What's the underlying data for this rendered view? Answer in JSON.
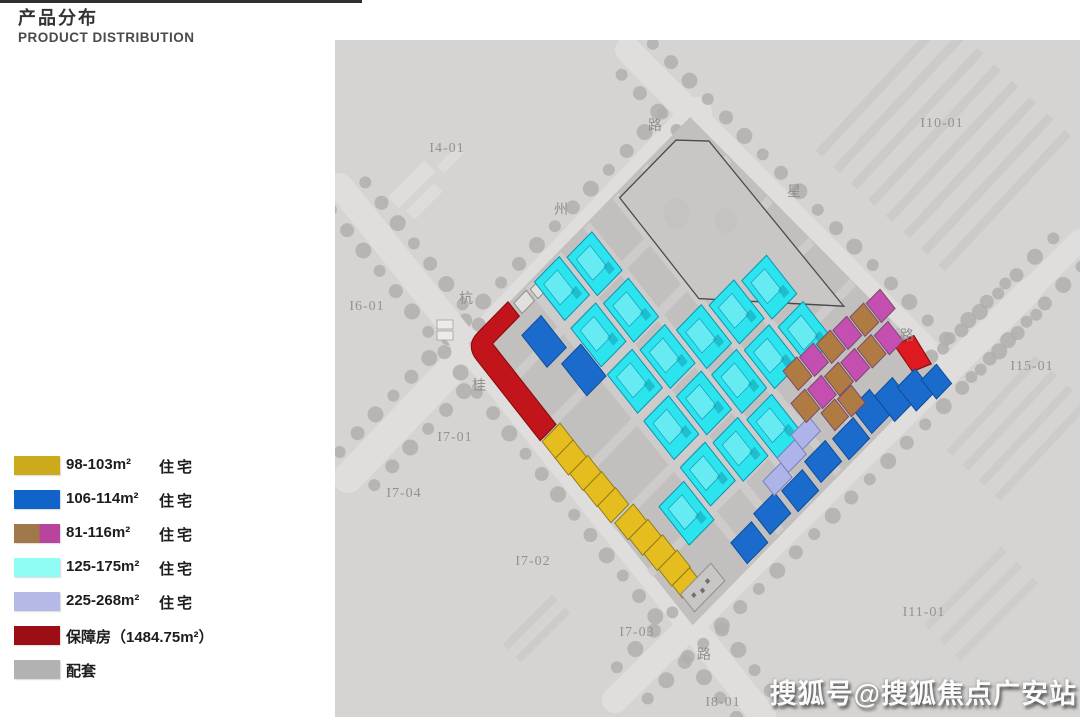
{
  "header": {
    "title_zh": "产品分布",
    "title_en": "PRODUCT DISTRIBUTION"
  },
  "watermark": "搜狐号@搜狐焦点广安站",
  "legend": {
    "items": [
      {
        "id": "98-103",
        "range": "98-103m²",
        "category": "住宅",
        "colors": [
          "#cbaa1c"
        ]
      },
      {
        "id": "106-114",
        "range": "106-114m²",
        "category": "住宅",
        "colors": [
          "#1063c8"
        ]
      },
      {
        "id": "81-116",
        "range": "81-116m²",
        "category": "住宅",
        "colors": [
          "#a0794a",
          "#b8449e"
        ]
      },
      {
        "id": "125-175",
        "range": "125-175m²",
        "category": "住宅",
        "colors": [
          "#8ffdf4"
        ]
      },
      {
        "id": "225-268",
        "range": "225-268m²",
        "category": "住宅",
        "colors": [
          "#b4b9e8"
        ]
      },
      {
        "id": "baozhangfang",
        "range": "保障房（1484.75m²）",
        "category": "",
        "colors": [
          "#9c0d15"
        ]
      },
      {
        "id": "peitao",
        "range": "配套",
        "category": "",
        "colors": [
          "#b2b2b2"
        ]
      }
    ]
  },
  "map": {
    "region": {
      "x": 335,
      "y": 40,
      "w": 745,
      "h": 677
    },
    "background": "#d6d4d2",
    "road_color": "#e0dedc",
    "tree_color": "#b2b0ae",
    "site_base": "#c2c0be",
    "inner_road_color": "#d0cecc",
    "roads": [
      {
        "x1": 348,
        "y1": 478,
        "x2": 697,
        "y2": 112,
        "w": 30
      },
      {
        "x1": 340,
        "y1": 186,
        "x2": 763,
        "y2": 716,
        "w": 26
      },
      {
        "x1": 628,
        "y1": 50,
        "x2": 948,
        "y2": 372,
        "w": 26
      },
      {
        "x1": 1030,
        "y1": 290,
        "x2": 615,
        "y2": 700,
        "w": 26
      },
      {
        "x1": 948,
        "y1": 372,
        "x2": 1080,
        "y2": 240,
        "w": 22
      }
    ],
    "parcel_labels": [
      {
        "text": "I4-01",
        "x": 447,
        "y": 152
      },
      {
        "text": "I10-01",
        "x": 942,
        "y": 127
      },
      {
        "text": "I6-01",
        "x": 367,
        "y": 310
      },
      {
        "text": "I15-01",
        "x": 1032,
        "y": 370
      },
      {
        "text": "I7-01",
        "x": 455,
        "y": 441
      },
      {
        "text": "I7-04",
        "x": 404,
        "y": 497
      },
      {
        "text": "I7-02",
        "x": 533,
        "y": 565
      },
      {
        "text": "I7-03",
        "x": 637,
        "y": 636
      },
      {
        "text": "I8-01",
        "x": 723,
        "y": 706
      },
      {
        "text": "I11-01",
        "x": 924,
        "y": 616
      }
    ],
    "road_name_labels": [
      {
        "text": "杭",
        "x": 466,
        "y": 303
      },
      {
        "text": "州",
        "x": 561,
        "y": 214
      },
      {
        "text": "路",
        "x": 655,
        "y": 130
      },
      {
        "text": "星",
        "x": 794,
        "y": 196
      },
      {
        "text": "路",
        "x": 907,
        "y": 340
      },
      {
        "text": "桂",
        "x": 479,
        "y": 390
      },
      {
        "text": "路",
        "x": 704,
        "y": 659
      }
    ],
    "site": {
      "matrix": [
        0.6875,
        -0.7031,
        0.6286,
        0.8,
        470,
        345
      ],
      "outline": [
        [
          0,
          -2
        ],
        [
          322,
          -2
        ],
        [
          364,
          352
        ],
        [
          2,
          352
        ]
      ],
      "inner_roads": {
        "u_lines": [
          86,
          128,
          170,
          212,
          254
        ],
        "v_lines": [
          54,
          112,
          170,
          228,
          286
        ]
      },
      "empty_parcel": {
        "points": [
          [
            214,
            4
          ],
          [
            296,
            4
          ],
          [
            322,
            28
          ],
          [
            326,
            238
          ],
          [
            214,
            130
          ]
        ],
        "stroke": "#4a4a4a",
        "fill": "#c9c7c5"
      }
    },
    "building_groups": [
      {
        "key": "peitao-shops",
        "fill": "#e2e0dc",
        "stroke": "#908e8c",
        "units": [
          [
            40,
            2,
            18,
            13
          ],
          [
            62,
            2,
            18,
            13
          ],
          [
            84,
            4,
            16,
            12
          ]
        ]
      },
      {
        "key": "baozhang-strip",
        "fill": "#c2151b",
        "stroke": "#8c0e12",
        "path": "M58,-3 L14,-3 Q-4,-3 -4,15 L-4,116 L19,116 L19,15 L58,15 Z"
      },
      {
        "key": "baozhang-corner",
        "fill": "#de1a20",
        "stroke": "#8c0e12",
        "path": "M342,302 L364,308 L360,340 L340,332 Z"
      },
      {
        "key": "yellow-98-103",
        "fill": "#e6bd1e",
        "stroke": "#8f7d19",
        "units": [
          [
            -3,
            118,
            26,
            21
          ],
          [
            -3,
            139,
            26,
            21
          ],
          [
            -1,
            160,
            26,
            21
          ],
          [
            0,
            181,
            26,
            21
          ],
          [
            1,
            202,
            26,
            21
          ],
          [
            4,
            226,
            27,
            21
          ],
          [
            6,
            247,
            27,
            21
          ],
          [
            8,
            268,
            27,
            21
          ],
          [
            10,
            289,
            27,
            21
          ],
          [
            11,
            310,
            25,
            16
          ]
        ]
      },
      {
        "key": "gray-corner",
        "fill": "#c9c7c5",
        "stroke": "#8f8d8b",
        "units": [
          [
            12,
            322,
            44,
            22
          ]
        ]
      },
      {
        "key": "blue-106-114",
        "fill": "#1a6bcc",
        "stroke": "#0d4d99",
        "units": [
          [
            48,
            30,
            28,
            40
          ],
          [
            62,
            78,
            28,
            40
          ],
          [
            85,
            322,
            30,
            26
          ],
          [
            122,
            318,
            30,
            26
          ],
          [
            159,
            322,
            30,
            26
          ],
          [
            196,
            318,
            30,
            26
          ],
          [
            233,
            322,
            30,
            26
          ],
          [
            268,
            314,
            26,
            32
          ],
          [
            294,
            322,
            26,
            32
          ],
          [
            318,
            332,
            26,
            30
          ],
          [
            342,
            344,
            22,
            24
          ]
        ]
      },
      {
        "key": "cyan-125-175",
        "fill": "#2be4ee",
        "stroke": "#0a93b5",
        "detail": true,
        "units": [
          [
            92,
            2,
            36,
            48
          ],
          [
            92,
            60,
            36,
            48
          ],
          [
            92,
            118,
            36,
            48
          ],
          [
            92,
            176,
            36,
            48
          ],
          [
            92,
            234,
            36,
            48
          ],
          [
            134,
            8,
            36,
            48
          ],
          [
            134,
            66,
            36,
            48
          ],
          [
            134,
            124,
            36,
            48
          ],
          [
            134,
            182,
            36,
            48
          ],
          [
            134,
            240,
            36,
            48
          ],
          [
            176,
            136,
            36,
            48
          ],
          [
            176,
            192,
            36,
            48
          ],
          [
            176,
            248,
            36,
            48
          ],
          [
            218,
            142,
            36,
            48
          ],
          [
            218,
            198,
            36,
            48
          ],
          [
            260,
            148,
            36,
            48
          ],
          [
            260,
            206,
            36,
            48
          ],
          [
            50,
            246,
            36,
            48
          ]
        ]
      },
      {
        "key": "lavender-225-268",
        "fill": "#aeb3e8",
        "stroke": "#7a80c0",
        "units": [
          [
            150,
            302,
            26,
            18
          ],
          [
            176,
            296,
            26,
            18
          ],
          [
            202,
            290,
            26,
            18
          ]
        ]
      },
      {
        "key": "mixed-81-116",
        "stroke": "#7a4a6e",
        "units": [
          [
            236,
            240,
            20,
            24
          ],
          [
            258,
            242,
            20,
            24
          ],
          [
            280,
            245,
            20,
            24
          ],
          [
            302,
            247,
            20,
            24
          ],
          [
            324,
            250,
            20,
            24
          ],
          [
            346,
            252,
            20,
            24
          ],
          [
            222,
            268,
            20,
            24
          ],
          [
            244,
            270,
            20,
            24
          ],
          [
            266,
            273,
            20,
            24
          ],
          [
            288,
            275,
            20,
            24
          ],
          [
            310,
            277,
            20,
            24
          ],
          [
            332,
            280,
            20,
            24
          ],
          [
            240,
            296,
            20,
            22
          ],
          [
            262,
            298,
            20,
            22
          ]
        ],
        "colors": [
          "#b07a43",
          "#c44fb0",
          "#b07a43",
          "#c44fb0",
          "#b07a43",
          "#c44fb0",
          "#b07a43",
          "#c44fb0",
          "#b07a43",
          "#c44fb0",
          "#b07a43",
          "#c44fb0",
          "#b07a43",
          "#b07a43"
        ]
      }
    ]
  }
}
